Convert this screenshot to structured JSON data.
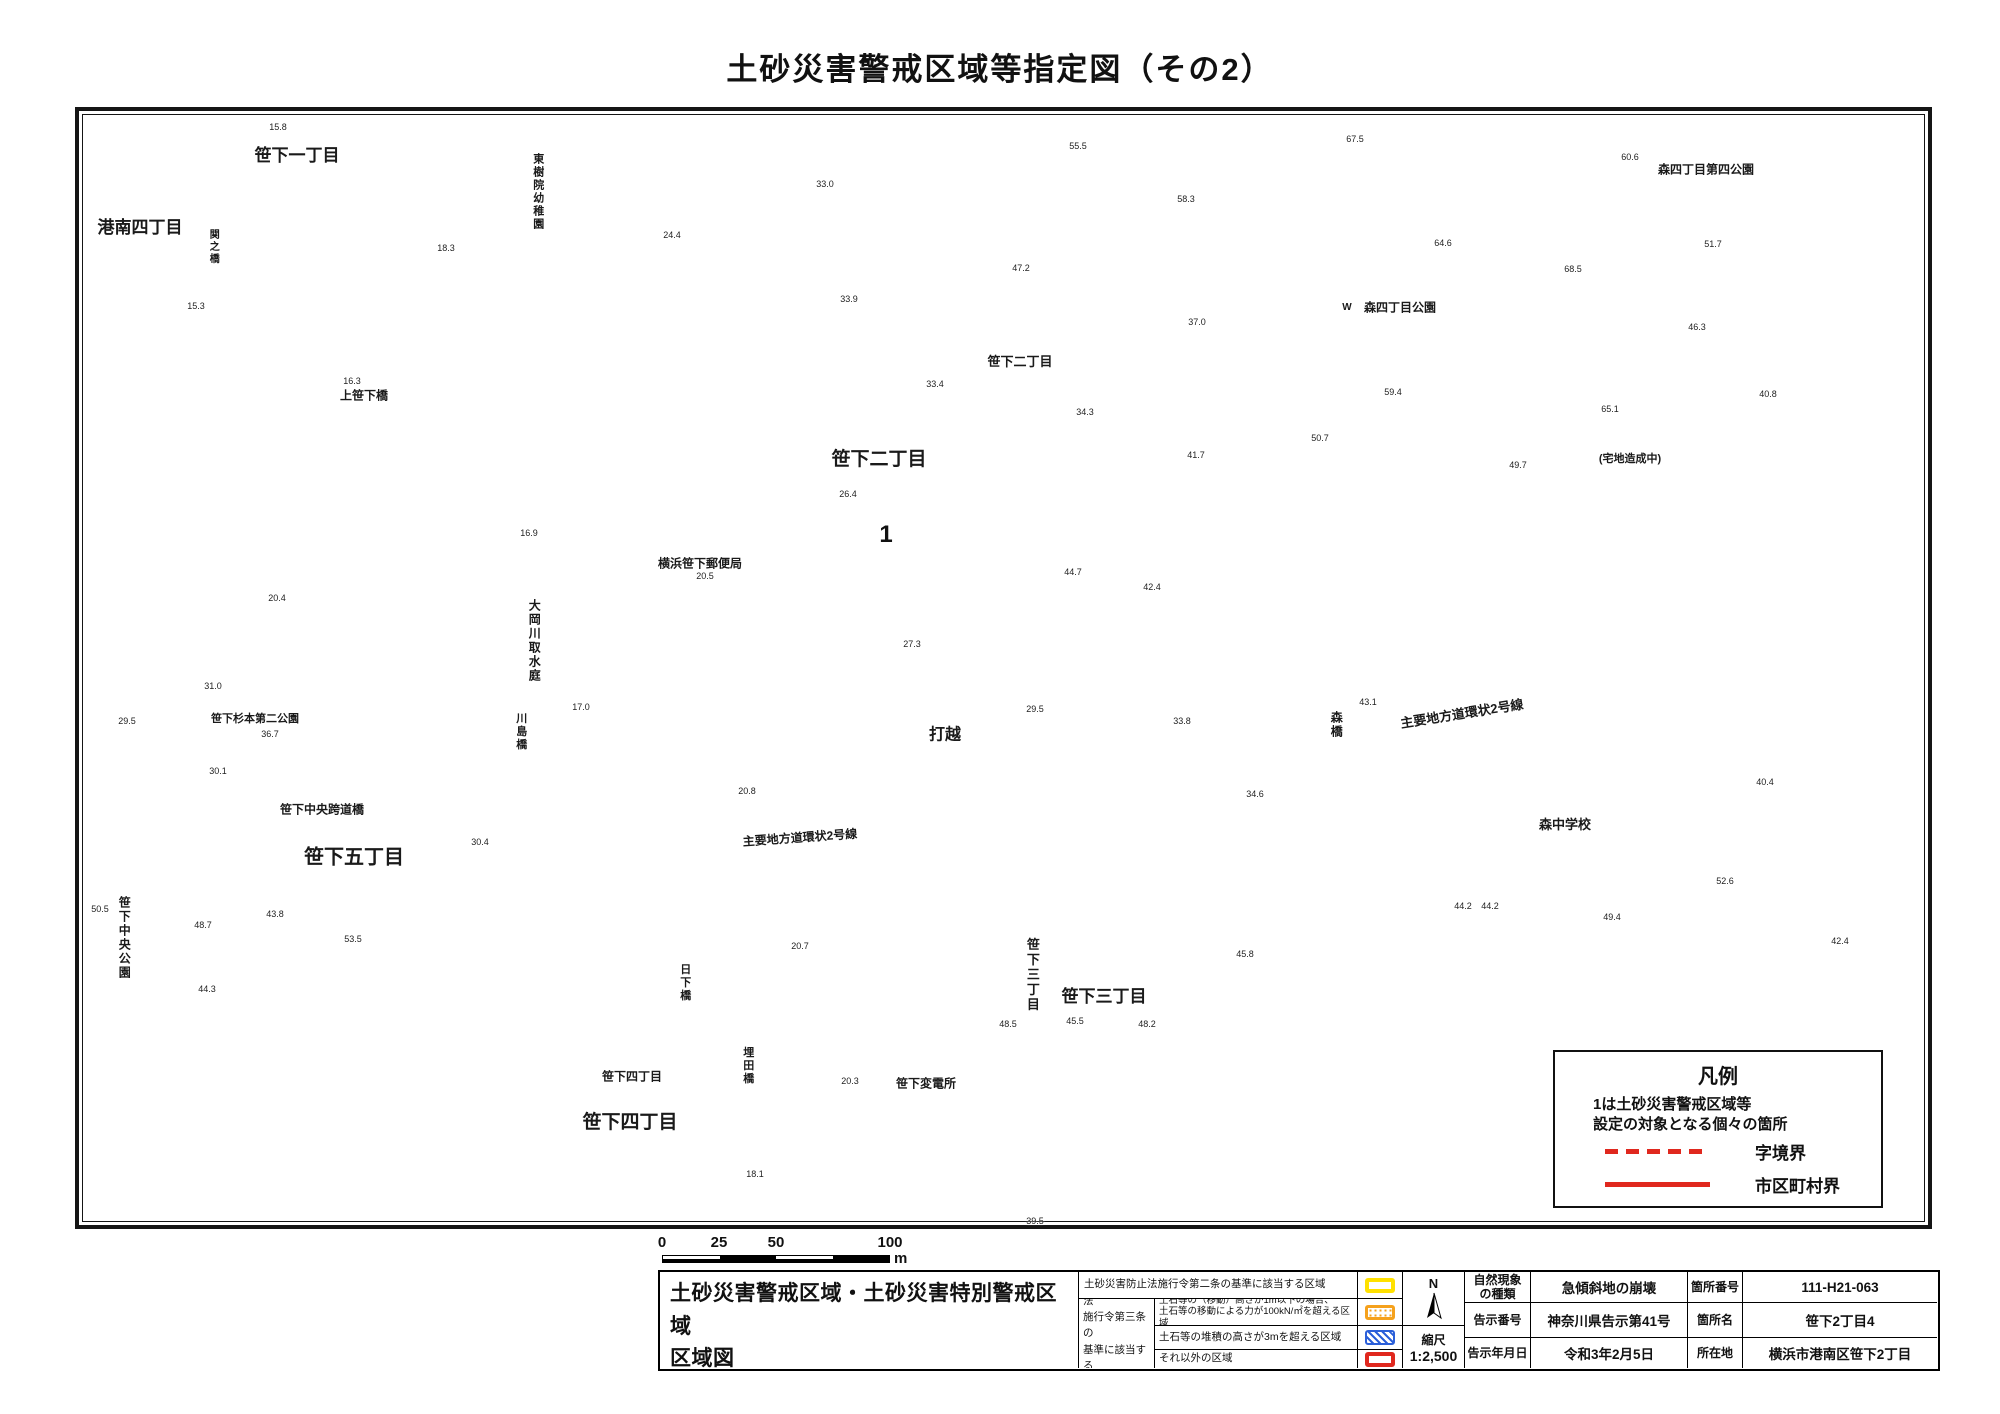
{
  "title": "土砂災害警戒区域等指定図（その2）",
  "colors": {
    "building_outline": "#2ba37c",
    "contour": "#b9b9b9",
    "road": "#8d8d8d",
    "boundary_red": "#e0281e",
    "zone_yellow_border": "#ffe100",
    "zone_yellow_fill": "#f5edaa",
    "special_zone_red": "#da1f1a"
  },
  "map": {
    "marker": {
      "label": "1"
    },
    "legend_box": {
      "title": "凡例",
      "desc": "1は土砂災害警戒区域等\n設定の対象となる個々の箇所",
      "dashed_label": "字境界",
      "solid_label": "市区町村界"
    },
    "scale_bar": {
      "ticks": [
        "0",
        "25",
        "50",
        "100"
      ],
      "unit": "m"
    },
    "area_labels": [
      {
        "t": "笹下一丁目",
        "x": 297,
        "y": 156,
        "s": 17
      },
      {
        "t": "港南四丁目",
        "x": 140,
        "y": 228,
        "s": 17
      },
      {
        "t": "東樹院幼稚園",
        "x": 537,
        "y": 192,
        "s": 11,
        "v": 1
      },
      {
        "t": "関之橋",
        "x": 212,
        "y": 247,
        "s": 10,
        "v": 1
      },
      {
        "t": "上笹下橋",
        "x": 364,
        "y": 396,
        "s": 12
      },
      {
        "t": "笹下二丁目",
        "x": 1020,
        "y": 362,
        "s": 13
      },
      {
        "t": "笹下二丁目",
        "x": 879,
        "y": 460,
        "s": 19
      },
      {
        "t": "横浜笹下郵便局",
        "x": 700,
        "y": 564,
        "s": 12
      },
      {
        "t": "大岡川取水庭",
        "x": 534,
        "y": 641,
        "s": 12,
        "v": 1
      },
      {
        "t": "川島橋",
        "x": 520,
        "y": 732,
        "s": 11,
        "v": 1
      },
      {
        "t": "笹下杉本第二公園",
        "x": 255,
        "y": 720,
        "s": 11
      },
      {
        "t": "笹下中央跨道橋",
        "x": 322,
        "y": 810,
        "s": 12
      },
      {
        "t": "笹下五丁目",
        "x": 354,
        "y": 858,
        "s": 20
      },
      {
        "t": "笹下中央公園",
        "x": 124,
        "y": 938,
        "s": 12,
        "v": 1
      },
      {
        "t": "主要地方道環状2号線",
        "x": 800,
        "y": 838,
        "s": 12,
        "r": -4
      },
      {
        "t": "主要地方道環状2号線",
        "x": 1462,
        "y": 714,
        "s": 13,
        "r": -9
      },
      {
        "t": "打越",
        "x": 945,
        "y": 736,
        "s": 16
      },
      {
        "t": "森橋",
        "x": 1336,
        "y": 725,
        "s": 12,
        "v": 1
      },
      {
        "t": "森四丁目公園",
        "x": 1400,
        "y": 308,
        "s": 12
      },
      {
        "t": "W",
        "x": 1347,
        "y": 308,
        "s": 10
      },
      {
        "t": "森四丁目第四公園",
        "x": 1706,
        "y": 170,
        "s": 12
      },
      {
        "t": "(宅地造成中)",
        "x": 1630,
        "y": 460,
        "s": 11
      },
      {
        "t": "森中学校",
        "x": 1565,
        "y": 825,
        "s": 13
      },
      {
        "t": "笹下三丁目",
        "x": 1032,
        "y": 975,
        "s": 13,
        "v": 1
      },
      {
        "t": "笹下三丁目",
        "x": 1104,
        "y": 997,
        "s": 17
      },
      {
        "t": "日下橋",
        "x": 684,
        "y": 983,
        "s": 11,
        "v": 1
      },
      {
        "t": "埋田橋",
        "x": 747,
        "y": 1066,
        "s": 11,
        "v": 1
      },
      {
        "t": "笹下変電所",
        "x": 926,
        "y": 1084,
        "s": 12
      },
      {
        "t": "笹下四丁目",
        "x": 632,
        "y": 1077,
        "s": 12
      },
      {
        "t": "笹下四丁目",
        "x": 630,
        "y": 1123,
        "s": 19
      }
    ],
    "spot_elevations": [
      [
        278,
        127,
        "15.8"
      ],
      [
        446,
        248,
        "18.3"
      ],
      [
        196,
        306,
        "15.3"
      ],
      [
        352,
        381,
        "16.3"
      ],
      [
        277,
        598,
        "20.4"
      ],
      [
        529,
        533,
        "16.9"
      ],
      [
        705,
        576,
        "20.5"
      ],
      [
        581,
        707,
        "17.0"
      ],
      [
        747,
        791,
        "20.8"
      ],
      [
        480,
        842,
        "30.4"
      ],
      [
        213,
        686,
        "31.0"
      ],
      [
        127,
        721,
        "29.5"
      ],
      [
        270,
        734,
        "36.7"
      ],
      [
        218,
        771,
        "30.1"
      ],
      [
        100,
        909,
        "50.5"
      ],
      [
        203,
        925,
        "48.7"
      ],
      [
        275,
        914,
        "43.8"
      ],
      [
        353,
        939,
        "53.5"
      ],
      [
        207,
        989,
        "44.3"
      ],
      [
        825,
        184,
        "33.0"
      ],
      [
        672,
        235,
        "24.4"
      ],
      [
        849,
        299,
        "33.9"
      ],
      [
        1021,
        268,
        "47.2"
      ],
      [
        935,
        384,
        "33.4"
      ],
      [
        1085,
        412,
        "34.3"
      ],
      [
        848,
        494,
        "26.4"
      ],
      [
        1196,
        455,
        "41.7"
      ],
      [
        1073,
        572,
        "44.7"
      ],
      [
        1152,
        587,
        "42.4"
      ],
      [
        912,
        644,
        "27.3"
      ],
      [
        1035,
        709,
        "29.5"
      ],
      [
        1182,
        721,
        "33.8"
      ],
      [
        1078,
        146,
        "55.5"
      ],
      [
        1186,
        199,
        "58.3"
      ],
      [
        1197,
        322,
        "37.0"
      ],
      [
        1355,
        139,
        "67.5"
      ],
      [
        1630,
        157,
        "60.6"
      ],
      [
        1443,
        243,
        "64.6"
      ],
      [
        1573,
        269,
        "68.5"
      ],
      [
        1713,
        244,
        "51.7"
      ],
      [
        1697,
        327,
        "46.3"
      ],
      [
        1393,
        392,
        "59.4"
      ],
      [
        1320,
        438,
        "50.7"
      ],
      [
        1768,
        394,
        "40.8"
      ],
      [
        1610,
        409,
        "65.1"
      ],
      [
        1518,
        465,
        "49.7"
      ],
      [
        1368,
        702,
        "43.1"
      ],
      [
        1255,
        794,
        "34.6"
      ],
      [
        1463,
        906,
        "44.2"
      ],
      [
        1245,
        954,
        "45.8"
      ],
      [
        1075,
        1021,
        "45.5"
      ],
      [
        1147,
        1024,
        "48.2"
      ],
      [
        800,
        946,
        "20.7"
      ],
      [
        850,
        1081,
        "20.3"
      ],
      [
        755,
        1174,
        "18.1"
      ],
      [
        1008,
        1024,
        "48.5"
      ],
      [
        1035,
        1221,
        "39.5"
      ],
      [
        1765,
        782,
        "40.4"
      ],
      [
        1725,
        881,
        "52.6"
      ],
      [
        1612,
        917,
        "49.4"
      ],
      [
        1490,
        906,
        "44.2"
      ],
      [
        1840,
        941,
        "42.4"
      ]
    ]
  },
  "info_table": {
    "map_title_line1": "土砂災害警戒区域・土砂災害特別警戒区域",
    "map_title_line2": "区域図",
    "row1_label": "土砂災害防止法施行令第二条の基準に該当する区域",
    "article3_label": "土砂災害防止法\n施行令第三条の\n基準に該当する\n区域",
    "article3_rows": [
      "土石等の（移動）高さが1m以下の場合、\n土石等の移動による力が100kN/㎡を超える区域",
      "土石等の堆積の高さが3mを超える区域",
      "それ以外の区域"
    ],
    "swatches": [
      "yellow-outline",
      "orange-dots",
      "blue-hatch",
      "red-outline"
    ],
    "north_label": "N",
    "scale_label": "縮尺",
    "scale_value": "1:2,500",
    "meta": [
      {
        "label": "自然現象\nの種類",
        "value": "急傾斜地の崩壊",
        "label2": "箇所番号",
        "value2": "111-H21-063"
      },
      {
        "label": "告示番号",
        "value": "神奈川県告示第41号",
        "label2": "箇所名",
        "value2": "笹下2丁目4"
      },
      {
        "label": "告示年月日",
        "value": "令和3年2月5日",
        "label2": "所在地",
        "value2": "横浜市港南区笹下2丁目"
      }
    ]
  }
}
